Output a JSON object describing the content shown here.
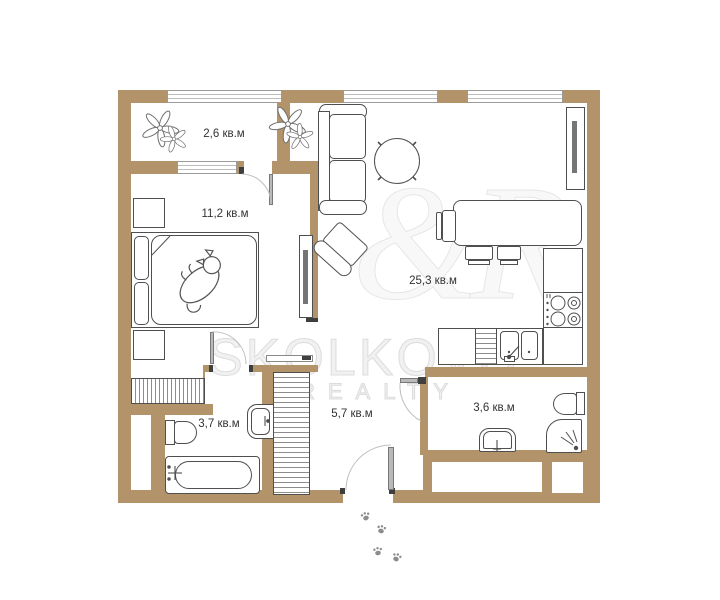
{
  "title": "apartment-floor-plan",
  "watermark": {
    "brand": "SKOLKOVO",
    "sub": "REALTY",
    "monogram": "&R"
  },
  "rooms": [
    {
      "name": "balcony",
      "area_label": "2,6 кв.м"
    },
    {
      "name": "bedroom",
      "area_label": "11,2 кв.м"
    },
    {
      "name": "living-kitchen",
      "area_label": "25,3 кв.м"
    },
    {
      "name": "bathroom",
      "area_label": "3,7 кв.м"
    },
    {
      "name": "hallway",
      "area_label": "5,7 кв.м"
    },
    {
      "name": "shower-room",
      "area_label": "3,6 кв.м"
    }
  ],
  "icons": [
    "plant-icon",
    "cat-icon",
    "paw-prints-icon",
    "stove-burners-icon",
    "shower-spray-icon",
    "faucet-icon"
  ],
  "counts": {
    "paw_prints": 4,
    "plants": 2
  },
  "colors": {
    "wall": "#b3946a",
    "furniture_outline": "#4f4f4f",
    "watermark": "#dcdcdc",
    "label_text": "#333333",
    "floor": "#ffffff"
  }
}
